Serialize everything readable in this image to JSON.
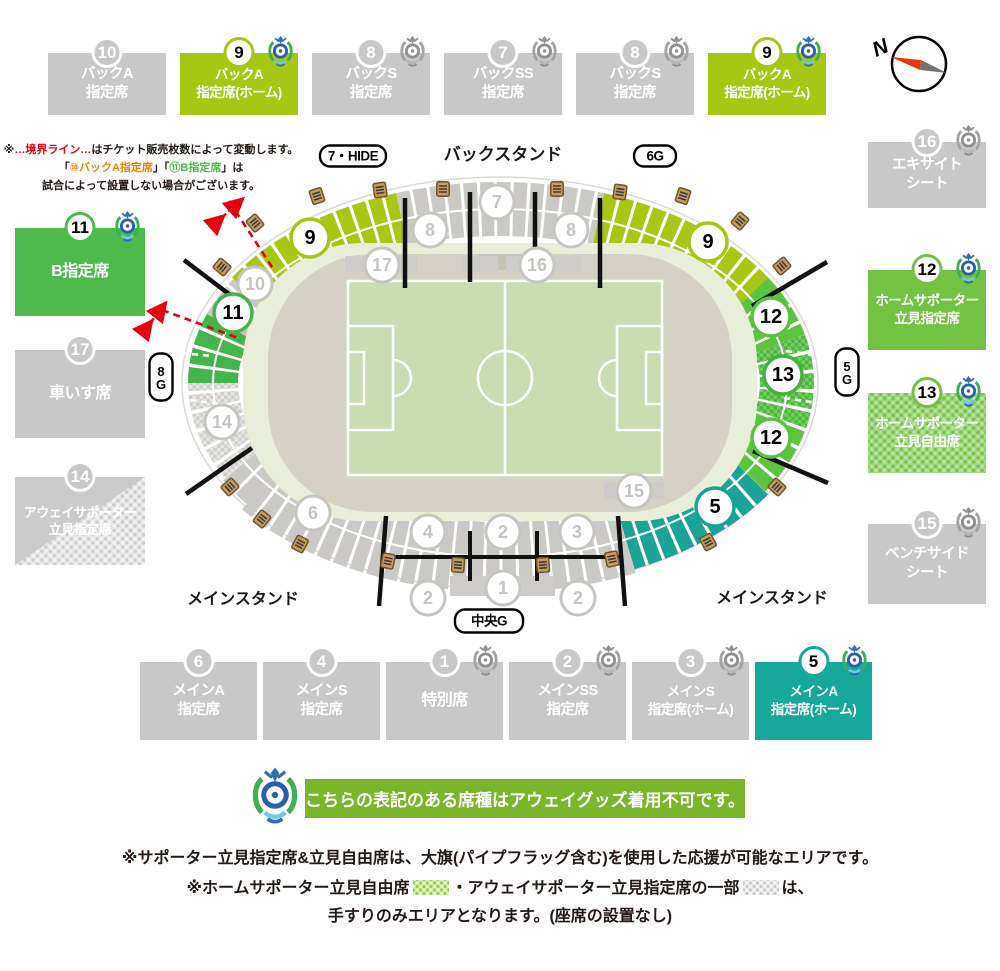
{
  "compass": {
    "label": "N"
  },
  "colors": {
    "yellow_green": "#a6c713",
    "bright_green": "#72c343",
    "green": "#4eba4b",
    "teal": "#16a89b",
    "gray": "#c8c8c8",
    "boundary_red": "#e60012",
    "away_bar_green": "#7ab62c",
    "pitch_green": "#c9dcb2"
  },
  "legend_boxes": {
    "top": [
      {
        "num": "10",
        "x": 48,
        "y": 53,
        "w": 118,
        "h": 62,
        "bg": "#c8c8c8",
        "circ": "gray",
        "logo": "none",
        "lines": [
          "バックA",
          "指定席"
        ]
      },
      {
        "num": "9",
        "x": 180,
        "y": 53,
        "w": 118,
        "h": 62,
        "bg": "#a6c713",
        "circ": "light",
        "logo": "color",
        "lines": [
          "バックA",
          "指定席(ホーム)"
        ],
        "fs": 13.5
      },
      {
        "num": "8",
        "x": 312,
        "y": 53,
        "w": 118,
        "h": 62,
        "bg": "#c8c8c8",
        "circ": "gray",
        "logo": "gray",
        "lines": [
          "バックS",
          "指定席"
        ]
      },
      {
        "num": "7",
        "x": 444,
        "y": 53,
        "w": 118,
        "h": 62,
        "bg": "#c8c8c8",
        "circ": "gray",
        "logo": "gray",
        "lines": [
          "バックSS",
          "指定席"
        ]
      },
      {
        "num": "8",
        "x": 576,
        "y": 53,
        "w": 118,
        "h": 62,
        "bg": "#c8c8c8",
        "circ": "gray",
        "logo": "gray",
        "lines": [
          "バックS",
          "指定席"
        ]
      },
      {
        "num": "9",
        "x": 708,
        "y": 53,
        "w": 118,
        "h": 62,
        "bg": "#a6c713",
        "circ": "light",
        "logo": "color",
        "lines": [
          "バックA",
          "指定席(ホーム)"
        ],
        "fs": 13.5
      }
    ],
    "right": [
      {
        "num": "16",
        "x": 868,
        "y": 142,
        "w": 118,
        "h": 66,
        "bg": "#c8c8c8",
        "circ": "gray",
        "logo": "gray",
        "lines": [
          "エキサイト",
          "シート"
        ]
      },
      {
        "num": "12",
        "x": 868,
        "y": 270,
        "w": 118,
        "h": 80,
        "bg": "#72c343",
        "circ": "light",
        "logo": "color",
        "lines": [
          "ホームサポーター",
          "立見指定席"
        ],
        "fs": 13.5
      },
      {
        "num": "13",
        "x": 868,
        "y": 393,
        "w": 118,
        "h": 80,
        "bg": "#72c343",
        "circ": "light",
        "logo": "color",
        "lines": [
          "ホームサポーター",
          "立見自由席"
        ],
        "fs": 13.5,
        "checker": "chk"
      },
      {
        "num": "15",
        "x": 868,
        "y": 524,
        "w": 118,
        "h": 80,
        "bg": "#c8c8c8",
        "circ": "gray",
        "logo": "gray",
        "lines": [
          "ベンチサイド",
          "シート"
        ]
      }
    ],
    "left": [
      {
        "num": "11",
        "x": 15,
        "y": 228,
        "w": 130,
        "h": 88,
        "bg": "#4eba4b",
        "circ": "light",
        "logo": "color",
        "lines": [
          "B指定席"
        ],
        "fs": 16
      },
      {
        "num": "17",
        "x": 15,
        "y": 350,
        "w": 130,
        "h": 88,
        "bg": "#c8c8c8",
        "circ": "gray",
        "logo": "none",
        "lines": [
          "車いす席"
        ],
        "fs": 16
      },
      {
        "num": "14",
        "x": 15,
        "y": 477,
        "w": 130,
        "h": 88,
        "bg": "#cbcbcb",
        "circ": "gray",
        "logo": "none",
        "lines": [
          "アウェイサポーター",
          "立見指定席"
        ],
        "fs": 13,
        "checker": "chk14"
      }
    ],
    "bottom": [
      {
        "num": "6",
        "x": 140,
        "y": 662,
        "w": 117,
        "h": 78,
        "bg": "#c8c8c8",
        "circ": "gray",
        "logo": "none",
        "lines": [
          "メインA",
          "指定席"
        ]
      },
      {
        "num": "4",
        "x": 263,
        "y": 662,
        "w": 117,
        "h": 78,
        "bg": "#c8c8c8",
        "circ": "gray",
        "logo": "none",
        "lines": [
          "メインS",
          "指定席"
        ]
      },
      {
        "num": "1",
        "x": 386,
        "y": 662,
        "w": 117,
        "h": 78,
        "bg": "#c8c8c8",
        "circ": "gray",
        "logo": "gray",
        "lines": [
          "特別席"
        ],
        "fs": 16
      },
      {
        "num": "2",
        "x": 509,
        "y": 662,
        "w": 117,
        "h": 78,
        "bg": "#c8c8c8",
        "circ": "gray",
        "logo": "gray",
        "lines": [
          "メインSS",
          "指定席"
        ]
      },
      {
        "num": "3",
        "x": 632,
        "y": 662,
        "w": 117,
        "h": 78,
        "bg": "#c8c8c8",
        "circ": "gray",
        "logo": "gray",
        "lines": [
          "メインS",
          "指定席(ホーム)"
        ],
        "fs": 13.5
      },
      {
        "num": "5",
        "x": 755,
        "y": 662,
        "w": 117,
        "h": 78,
        "bg": "#16a89b",
        "circ": "light",
        "logo": "color",
        "lines": [
          "メインA",
          "指定席(ホーム)"
        ],
        "fs": 13.5
      }
    ]
  },
  "notes_boundary": {
    "lines": [
      [
        {
          "t": "※",
          "c": "#231815"
        },
        {
          "t": "…境界ライン…",
          "c": "#e60012"
        },
        {
          "t": "はチケット販売枚数によって変動します。",
          "c": "#231815"
        }
      ],
      [
        {
          "t": "「",
          "c": "#231815"
        },
        {
          "t": "⑩バックA指定席",
          "c": "#ef8200"
        },
        {
          "t": "」「",
          "c": "#231815"
        },
        {
          "t": "⑪B指定席",
          "c": "#4cb848"
        },
        {
          "t": "」は",
          "c": "#231815"
        }
      ],
      [
        {
          "t": "試合によって設置しない場合がございます。",
          "c": "#231815"
        }
      ]
    ]
  },
  "away_bar": {
    "text": "こちらの表記のある席種はアウェイグッズ着用不可です。"
  },
  "footer_notes": {
    "line1": "※サポーター立見指定席&立見自由席は、大旗(パイプフラッグ含む)を使用した応援が可能なエリアです。",
    "line2": [
      {
        "t": "※ホームサポーター立見自由席"
      },
      {
        "swatch": "green"
      },
      {
        "t": "・アウェイサポーター立見指定席の一部"
      },
      {
        "swatch": "gray"
      },
      {
        "t": "は、"
      }
    ],
    "line3": "手すりのみエリアとなります。(座席の設置なし)"
  },
  "stadium": {
    "stand_labels": [
      {
        "t": "バックスタンド",
        "x": 503,
        "y": 160,
        "fs": 17
      },
      {
        "t": "メインスタンド",
        "x": 243,
        "y": 604,
        "fs": 16
      },
      {
        "t": "メインスタンド",
        "x": 772,
        "y": 603,
        "fs": 16
      }
    ],
    "gates": [
      {
        "t": "7・HIDE",
        "x": 353,
        "y": 156,
        "w": 66,
        "h": 21
      },
      {
        "t": "6G",
        "x": 655,
        "y": 156,
        "w": 42,
        "h": 21
      },
      {
        "t": "中央G",
        "x": 489,
        "y": 621,
        "w": 68,
        "h": 23
      },
      {
        "t": "8G",
        "x": 161,
        "y": 377,
        "w": 23,
        "h": 47,
        "vert": true
      },
      {
        "t": "5G",
        "x": 847,
        "y": 372,
        "w": 23,
        "h": 47,
        "vert": true
      }
    ],
    "section_circles": [
      {
        "n": "9",
        "x": 310,
        "y": 238,
        "s": "yg"
      },
      {
        "n": "8",
        "x": 430,
        "y": 230,
        "s": "gray"
      },
      {
        "n": "7",
        "x": 497,
        "y": 202,
        "s": "gray"
      },
      {
        "n": "8",
        "x": 571,
        "y": 230,
        "s": "gray"
      },
      {
        "n": "9",
        "x": 708,
        "y": 242,
        "s": "yg"
      },
      {
        "n": "10",
        "x": 255,
        "y": 284,
        "s": "gray"
      },
      {
        "n": "11",
        "x": 233,
        "y": 313,
        "s": "g11"
      },
      {
        "n": "17",
        "x": 382,
        "y": 265,
        "s": "gray"
      },
      {
        "n": "16",
        "x": 537,
        "y": 265,
        "s": "gray"
      },
      {
        "n": "12",
        "x": 771,
        "y": 317,
        "s": "g12"
      },
      {
        "n": "13",
        "x": 783,
        "y": 375,
        "s": "g13"
      },
      {
        "n": "12",
        "x": 771,
        "y": 438,
        "s": "g12"
      },
      {
        "n": "14",
        "x": 222,
        "y": 422,
        "s": "gray"
      },
      {
        "n": "6",
        "x": 313,
        "y": 513,
        "s": "gray"
      },
      {
        "n": "4",
        "x": 428,
        "y": 532,
        "s": "gray"
      },
      {
        "n": "2",
        "x": 503,
        "y": 532,
        "s": "gray"
      },
      {
        "n": "3",
        "x": 577,
        "y": 532,
        "s": "gray"
      },
      {
        "n": "2",
        "x": 428,
        "y": 598,
        "s": "gray"
      },
      {
        "n": "1",
        "x": 503,
        "y": 588,
        "s": "gray"
      },
      {
        "n": "2",
        "x": 578,
        "y": 598,
        "s": "gray"
      },
      {
        "n": "15",
        "x": 634,
        "y": 491,
        "s": "gray"
      },
      {
        "n": "5",
        "x": 715,
        "y": 507,
        "s": "teal"
      }
    ]
  }
}
